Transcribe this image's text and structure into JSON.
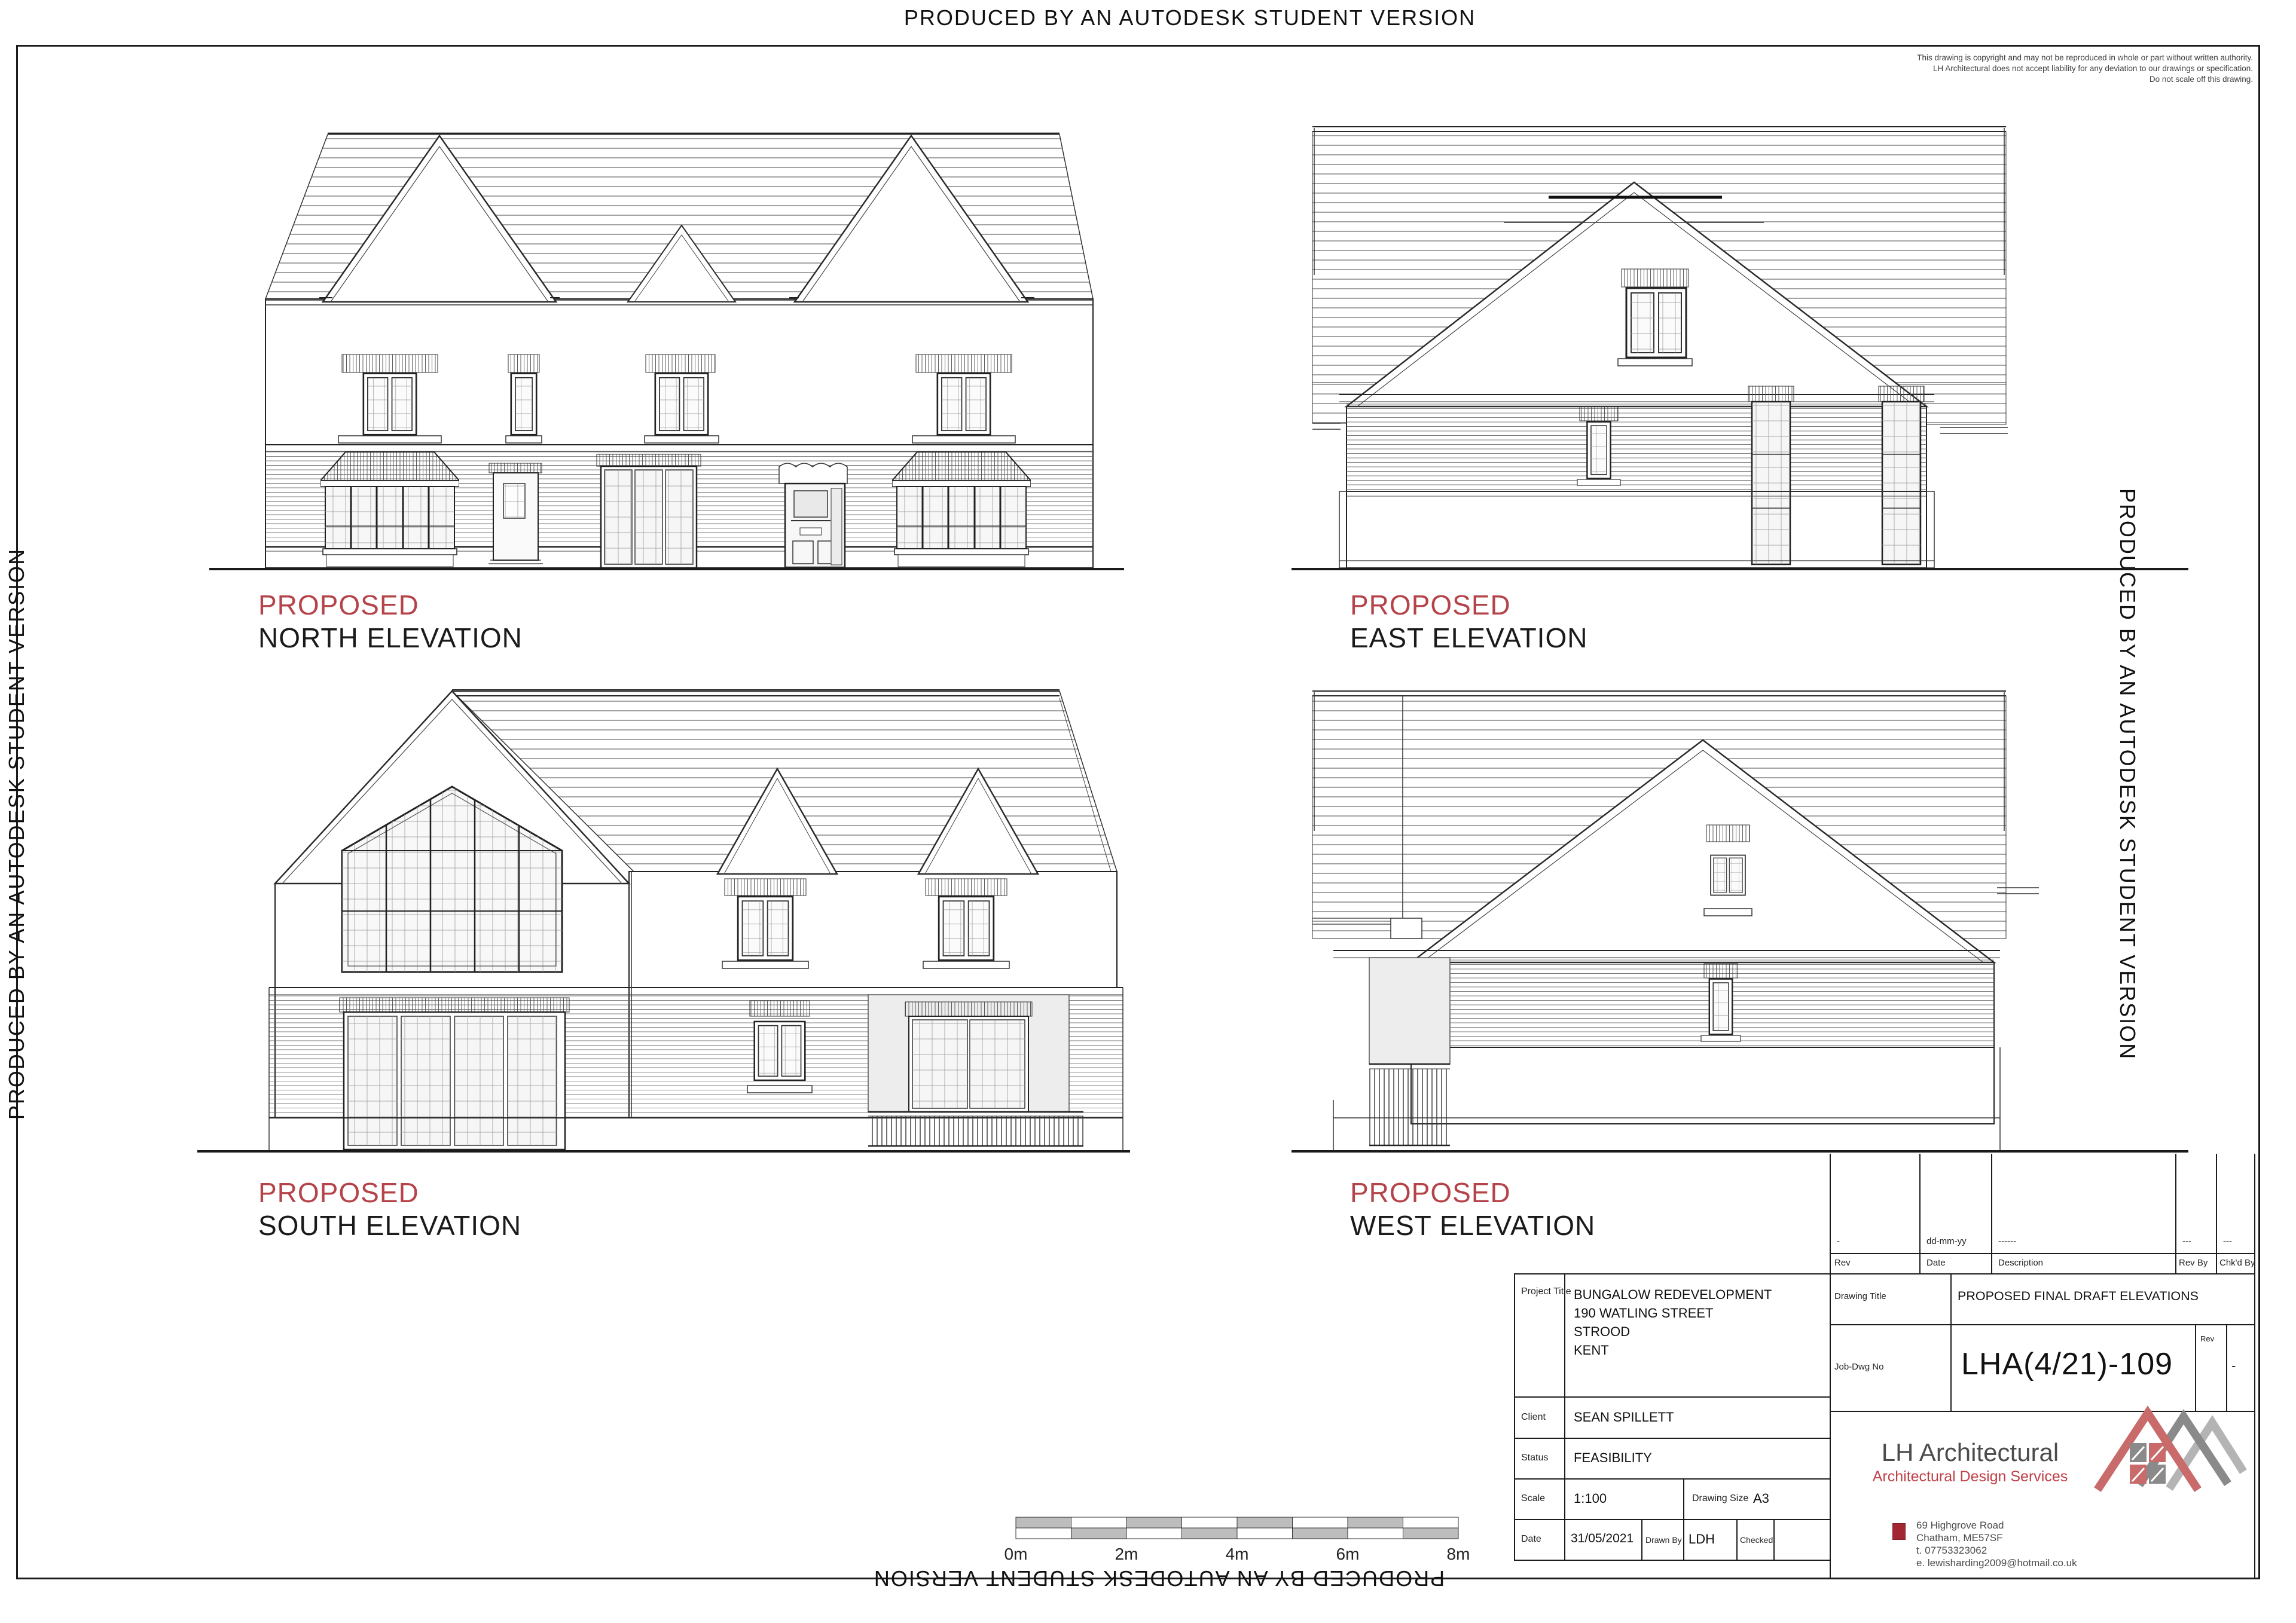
{
  "page": {
    "produced_text": "PRODUCED BY AN AUTODESK STUDENT VERSION"
  },
  "copyright": {
    "line1": "This drawing is copyright and may not be reproduced in whole or part without written authority.",
    "line2": "LH Architectural does not accept liability for any deviation to our drawings or specification.",
    "line3": "Do not scale off this drawing."
  },
  "elevations": [
    {
      "proposed": "PROPOSED",
      "name": "NORTH ELEVATION"
    },
    {
      "proposed": "PROPOSED",
      "name": "EAST ELEVATION"
    },
    {
      "proposed": "PROPOSED",
      "name": "SOUTH ELEVATION"
    },
    {
      "proposed": "PROPOSED",
      "name": "WEST ELEVATION"
    }
  ],
  "revision_table": {
    "columns": [
      "Rev",
      "Date",
      "Description",
      "Rev By",
      "Chk'd By"
    ],
    "rows": [
      [
        "-",
        "dd-mm-yy",
        "------",
        "---",
        "---"
      ]
    ]
  },
  "title_block": {
    "project_title_label": "Project Title",
    "project_title_lines": [
      "BUNGALOW REDEVELOPMENT",
      "190 WATLING STREET",
      "STROOD",
      "KENT"
    ],
    "client_label": "Client",
    "client": "SEAN SPILLETT",
    "status_label": "Status",
    "status": "FEASIBILITY",
    "scale_label": "Scale",
    "scale": "1:100",
    "drawing_size_label": "Drawing Size",
    "drawing_size": "A3",
    "date_label": "Date",
    "date": "31/05/2021",
    "drawn_by_label": "Drawn By",
    "drawn_by": "LDH",
    "checked_label": "Checked",
    "checked": "",
    "drawing_title_label": "Drawing Title",
    "drawing_title": "PROPOSED FINAL DRAFT ELEVATIONS",
    "job_dwg_no_label": "Job-Dwg No",
    "job_dwg_no": "LHA(4/21)-109",
    "rev_label": "Rev",
    "rev": "-"
  },
  "branding": {
    "company": "LH Architectural",
    "tagline": "Architectural Design Services",
    "address_lines": [
      "69 Highgrove Road",
      "Chatham, ME57SF",
      "t.  07753323062",
      "e. lewisharding2009@hotmail.co.uk"
    ]
  },
  "scale_bar": {
    "labels": [
      "0m",
      "2m",
      "4m",
      "6m",
      "8m"
    ]
  },
  "colors": {
    "accent_red": "#b5444a",
    "logo_red": "#c96a6b",
    "logo_dark_gray": "#8a8a8a",
    "logo_light_gray": "#b4b4b4",
    "bullet_red": "#a32733"
  }
}
